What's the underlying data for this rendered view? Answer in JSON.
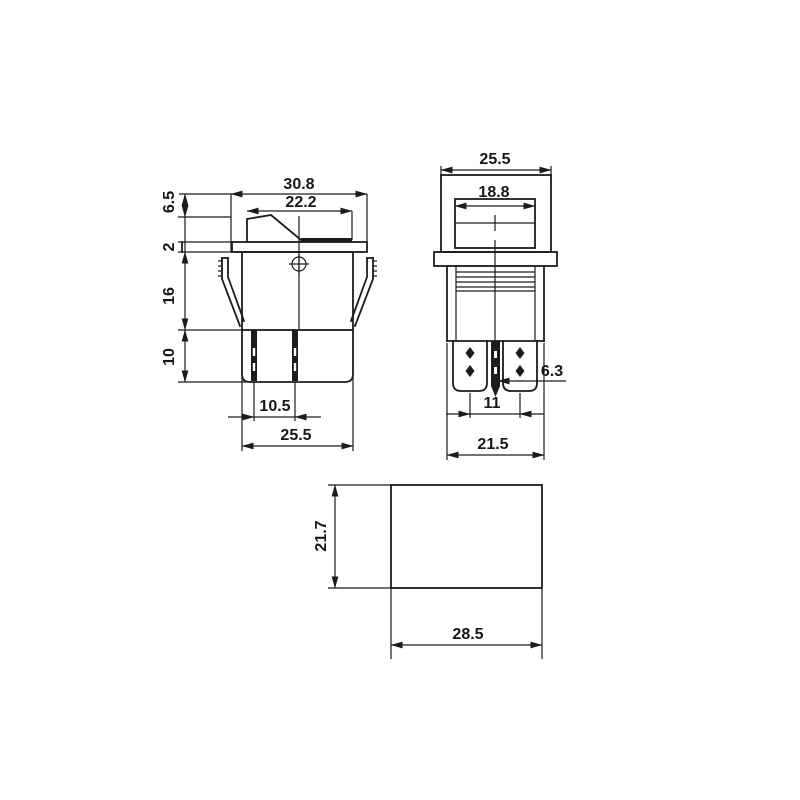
{
  "meta": {
    "drawing_type": "rocker switch dimensional drawing",
    "units": "mm",
    "ink_color": "#1c1c1c",
    "paper_color": "#ffffff"
  },
  "front": {
    "label_top_width": "30.8",
    "label_rocker_width": "22.2",
    "label_rocker_height": "6.5",
    "label_bezel_thickness": "2",
    "label_body_height": "16",
    "label_terminal_length": "10",
    "label_row_spacing": "10.5",
    "label_body_width": "25.5"
  },
  "side": {
    "label_top_width": "25.5",
    "label_actuator_width": "18.8",
    "label_terminal_width": "6.3",
    "label_pin_spacing": "11",
    "label_body_width": "21.5"
  },
  "cutout": {
    "label_height": "21.7",
    "label_width": "28.5"
  }
}
